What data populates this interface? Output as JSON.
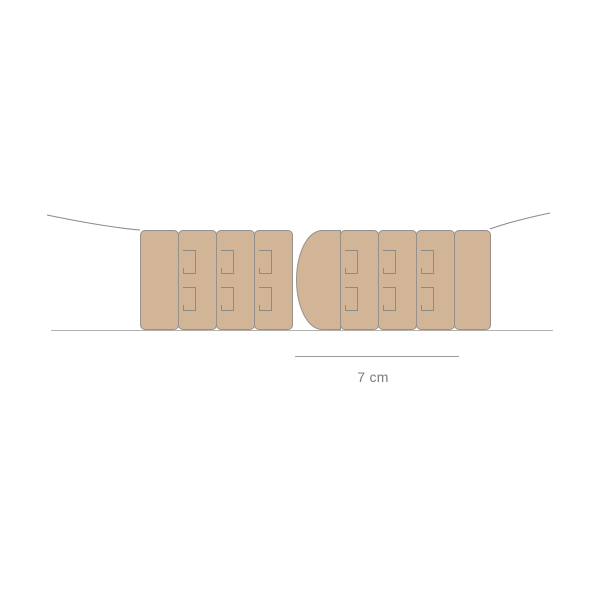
{
  "measurement": {
    "label": "7 cm"
  },
  "colors": {
    "background": "#ffffff",
    "panel_fill": "#d2b496",
    "panel_border": "#96918b",
    "hook_stroke": "#8e8a85",
    "strap_line": "#8f8b87",
    "baseline": "#b3b1ae",
    "measure_line": "#9a9a9a",
    "label_text": "#7c7c7c"
  },
  "diagram": {
    "band": {
      "top": 230,
      "height": 100
    },
    "hook": {
      "left": 4,
      "width": 13,
      "height": 24,
      "tops": [
        19,
        56
      ]
    },
    "groups": [
      {
        "name": "left-hook-strip",
        "panels": [
          {
            "type": "plain",
            "left": 140,
            "width": 39,
            "hooks": 0
          },
          {
            "type": "hook-panel",
            "left": 178,
            "width": 39,
            "hooks": 2
          },
          {
            "type": "hook-panel",
            "left": 216,
            "width": 39,
            "hooks": 2
          },
          {
            "type": "hook-panel",
            "left": 254,
            "width": 39,
            "hooks": 2
          }
        ]
      },
      {
        "name": "right-hook-strip",
        "panels": [
          {
            "type": "rounded-end",
            "left": 296,
            "width": 45,
            "hooks": 0
          },
          {
            "type": "hook-panel",
            "left": 340,
            "width": 39,
            "hooks": 2
          },
          {
            "type": "hook-panel",
            "left": 378,
            "width": 39,
            "hooks": 2
          },
          {
            "type": "hook-panel",
            "left": 416,
            "width": 39,
            "hooks": 2
          },
          {
            "type": "plain",
            "left": 454,
            "width": 37,
            "hooks": 0
          }
        ]
      }
    ]
  }
}
